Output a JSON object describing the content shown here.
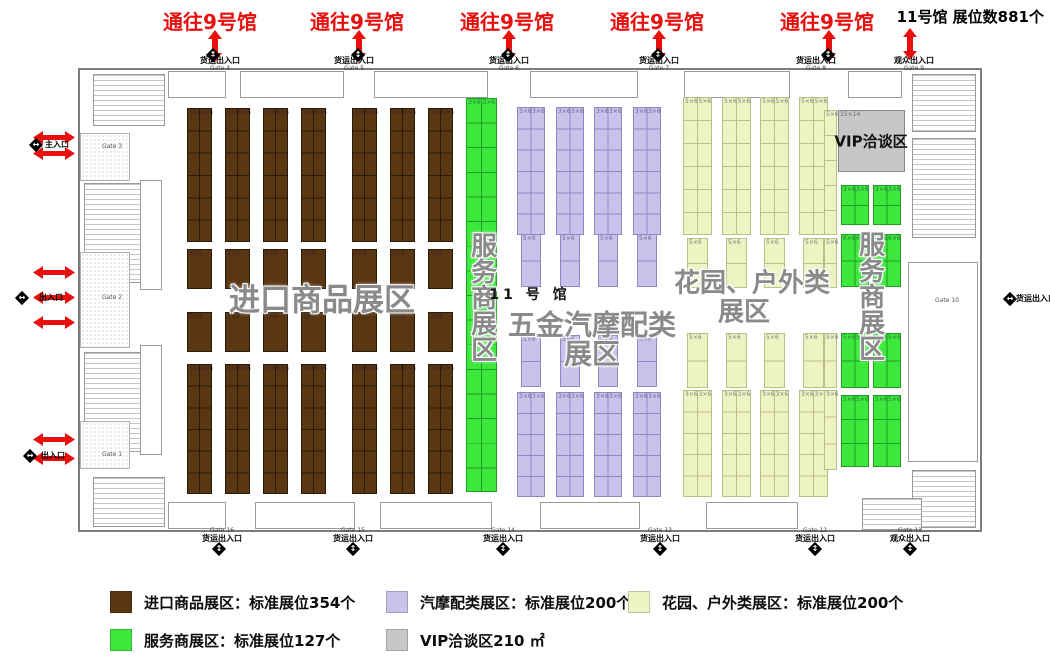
{
  "hall_title": "11号馆 展位数881个",
  "corridor_links": {
    "label": "通往9号馆",
    "positions_x": [
      210,
      357,
      507,
      657,
      827
    ]
  },
  "zone_labels": [
    {
      "text": "进口商品展区",
      "x": 322,
      "y": 301,
      "size": 31,
      "kind": "zone",
      "vertical": false
    },
    {
      "text": "服务商展区",
      "x": 481,
      "y": 297,
      "size": 26,
      "kind": "zone",
      "vertical": true
    },
    {
      "text": "11 号 馆",
      "x": 530,
      "y": 294,
      "size": 14,
      "kind": "hall",
      "vertical": false
    },
    {
      "text": "五金汽摩配类",
      "x": 592,
      "y": 325,
      "size": 28,
      "kind": "zone",
      "vertical": false
    },
    {
      "text": "展区",
      "x": 592,
      "y": 354,
      "size": 28,
      "kind": "zone",
      "vertical": false
    },
    {
      "text": "花园、户外类",
      "x": 752,
      "y": 284,
      "size": 26,
      "kind": "zone",
      "vertical": false
    },
    {
      "text": "展区",
      "x": 744,
      "y": 313,
      "size": 26,
      "kind": "zone",
      "vertical": false
    },
    {
      "text": "服务商展区",
      "x": 869,
      "y": 296,
      "size": 26,
      "kind": "zone",
      "vertical": true
    },
    {
      "text": "VIP洽谈区",
      "x": 871,
      "y": 141,
      "size": 15,
      "kind": "hall",
      "vertical": false
    }
  ],
  "gates": {
    "top": [
      {
        "label": "货运出入口",
        "gate": "Gate 4",
        "x": 220
      },
      {
        "label": "货运出入口",
        "gate": "Gate 5",
        "x": 354
      },
      {
        "label": "货运出入口",
        "gate": "Gate 6",
        "x": 509
      },
      {
        "label": "货运出入口",
        "gate": "Gate 7",
        "x": 659
      },
      {
        "label": "货运出入口",
        "gate": "Gate 8",
        "x": 816
      },
      {
        "label": "观众出入口",
        "gate": "Gate 9",
        "x": 914
      }
    ],
    "bottom": [
      {
        "label": "货运出入口",
        "gate": "Gate 16",
        "x": 222
      },
      {
        "label": "货运出入口",
        "gate": "Gate 15",
        "x": 353
      },
      {
        "label": "货运出入口",
        "gate": "Gate 14",
        "x": 503
      },
      {
        "label": "货运出入口",
        "gate": "Gate 13",
        "x": 660
      },
      {
        "label": "货运出入口",
        "gate": "Gate 12",
        "x": 815
      },
      {
        "label": "观众出入口",
        "gate": "Gate 11",
        "x": 910
      }
    ],
    "left_entrances": [
      {
        "label": "主入口",
        "x": 57,
        "y": 145
      },
      {
        "label": "出入口",
        "x": 51,
        "y": 298
      },
      {
        "label": "出入口",
        "x": 53,
        "y": 456
      }
    ],
    "right_entrance": {
      "label": "货运出入口",
      "x": 1036,
      "y": 299
    },
    "wall_tags": [
      {
        "text": "Gate 3",
        "x": 112,
        "y": 147
      },
      {
        "text": "Gate 2",
        "x": 112,
        "y": 298
      },
      {
        "text": "Gate 1",
        "x": 112,
        "y": 455
      },
      {
        "text": "Gate 10",
        "x": 947,
        "y": 301
      }
    ]
  },
  "legend": {
    "items": [
      {
        "color": "#5a3612",
        "text": "进口商品展区：标准展位354个"
      },
      {
        "color": "#c9c3ec",
        "text": "汽摩配类展区：标准展位200个"
      },
      {
        "color": "#eef3c3",
        "text": "花园、户外类展区：标准展位200个"
      },
      {
        "color": "#3ce83c",
        "text": "服务商展区：标准展位127个"
      },
      {
        "color": "#c7c7c7",
        "text": "VIP洽谈区210 ㎡"
      }
    ]
  },
  "floorplan": {
    "sections": [
      {
        "name": "import-goods",
        "color": "#5a3612",
        "border": "#2b1a05",
        "colW": 25,
        "columns": [
          187,
          225,
          263,
          301,
          352,
          390,
          428
        ],
        "bands": [
          {
            "y": 108,
            "h": 134,
            "rows": 6,
            "double": true,
            "label": "3×6"
          },
          {
            "y": 249,
            "h": 40,
            "rows": 1,
            "double": false,
            "label": "3×9"
          },
          {
            "y": 312,
            "h": 40,
            "rows": 1,
            "double": false,
            "label": "3×9"
          },
          {
            "y": 364,
            "h": 130,
            "rows": 6,
            "double": true,
            "label": "3×6"
          }
        ]
      },
      {
        "name": "service-left",
        "color": "#3ce83c",
        "border": "#1f9e1f",
        "colW": 31,
        "columns": [
          466
        ],
        "bands": [
          {
            "y": 98,
            "h": 394,
            "rows": 16,
            "double": true,
            "label": "3×6"
          }
        ]
      },
      {
        "name": "hardware-auto",
        "color": "#c9c3ec",
        "border": "#8f86c8",
        "colW": 28,
        "columns": [
          517,
          556,
          594,
          633
        ],
        "bands": [
          {
            "y": 107,
            "h": 128,
            "rows": 6,
            "double": true,
            "label": "3×6"
          },
          {
            "y": 234,
            "h": 53,
            "rows": 2,
            "double": false,
            "label": "5×6",
            "w": 20,
            "dx": 4
          },
          {
            "y": 335,
            "h": 52,
            "rows": 2,
            "double": false,
            "label": "5×6",
            "w": 20,
            "dx": 4
          },
          {
            "y": 392,
            "h": 105,
            "rows": 5,
            "double": true,
            "label": "3×6"
          }
        ]
      },
      {
        "name": "garden-outdoor",
        "color": "#eef3c3",
        "border": "#b9bf85",
        "colW": 29,
        "columns": [
          683,
          722,
          760,
          799
        ],
        "bands": [
          {
            "y": 97,
            "h": 138,
            "rows": 6,
            "double": true,
            "label": "5×6"
          },
          {
            "y": 238,
            "h": 50,
            "rows": 2,
            "double": false,
            "label": "5×6",
            "w": 21,
            "dx": 4
          },
          {
            "y": 333,
            "h": 55,
            "rows": 2,
            "double": false,
            "label": "5×6",
            "w": 21,
            "dx": 4
          },
          {
            "y": 390,
            "h": 107,
            "rows": 5,
            "double": true,
            "label": "3×6"
          }
        ]
      },
      {
        "name": "garden-strip",
        "color": "#eef3c3",
        "border": "#b9bf85",
        "colW": 13,
        "columns": [
          824
        ],
        "bands": [
          {
            "y": 110,
            "h": 125,
            "rows": 5,
            "double": false,
            "label": "5×6"
          },
          {
            "y": 238,
            "h": 50,
            "rows": 2,
            "double": false,
            "label": "5×6"
          },
          {
            "y": 333,
            "h": 55,
            "rows": 2,
            "double": false,
            "label": "5×6"
          },
          {
            "y": 390,
            "h": 80,
            "rows": 3,
            "double": false,
            "label": "3×6"
          }
        ]
      },
      {
        "name": "service-right",
        "color": "#3ce83c",
        "border": "#1f9e1f",
        "colW": 28,
        "columns": [
          841,
          873
        ],
        "bands": [
          {
            "y": 185,
            "h": 40,
            "rows": 2,
            "double": true,
            "label": "3×6"
          },
          {
            "y": 234,
            "h": 53,
            "rows": 2,
            "double": true,
            "label": "6×6"
          },
          {
            "y": 333,
            "h": 55,
            "rows": 2,
            "double": true,
            "label": "5×6"
          },
          {
            "y": 395,
            "h": 72,
            "rows": 3,
            "double": true,
            "label": "5×6"
          }
        ]
      }
    ],
    "vip": {
      "x": 838,
      "y": 110,
      "w": 67,
      "h": 62,
      "color": "#c7c7c7",
      "border": "#8a8a8a",
      "label": "15×14"
    }
  },
  "arrows": {
    "red": "#e8100e",
    "vertical": [
      {
        "x": 215,
        "y": 30
      },
      {
        "x": 359,
        "y": 30
      },
      {
        "x": 509,
        "y": 30
      },
      {
        "x": 659,
        "y": 30
      },
      {
        "x": 829,
        "y": 30
      },
      {
        "x": 910,
        "y": 28
      }
    ],
    "horizontal": [
      {
        "x": 33,
        "y": 131
      },
      {
        "x": 33,
        "y": 147
      },
      {
        "x": 33,
        "y": 266
      },
      {
        "x": 33,
        "y": 291
      },
      {
        "x": 33,
        "y": 316
      },
      {
        "x": 33,
        "y": 433
      },
      {
        "x": 33,
        "y": 452
      }
    ]
  },
  "diamonds": {
    "vertical": [
      {
        "x": 213,
        "y": 55
      },
      {
        "x": 358,
        "y": 55
      },
      {
        "x": 508,
        "y": 55
      },
      {
        "x": 658,
        "y": 55
      },
      {
        "x": 828,
        "y": 55
      },
      {
        "x": 219,
        "y": 549
      },
      {
        "x": 353,
        "y": 549
      },
      {
        "x": 503,
        "y": 549
      },
      {
        "x": 660,
        "y": 549
      },
      {
        "x": 815,
        "y": 549
      },
      {
        "x": 910,
        "y": 549
      }
    ],
    "horizontal": [
      {
        "x": 36,
        "y": 145
      },
      {
        "x": 22,
        "y": 298
      },
      {
        "x": 30,
        "y": 456
      },
      {
        "x": 1010,
        "y": 299
      }
    ]
  }
}
